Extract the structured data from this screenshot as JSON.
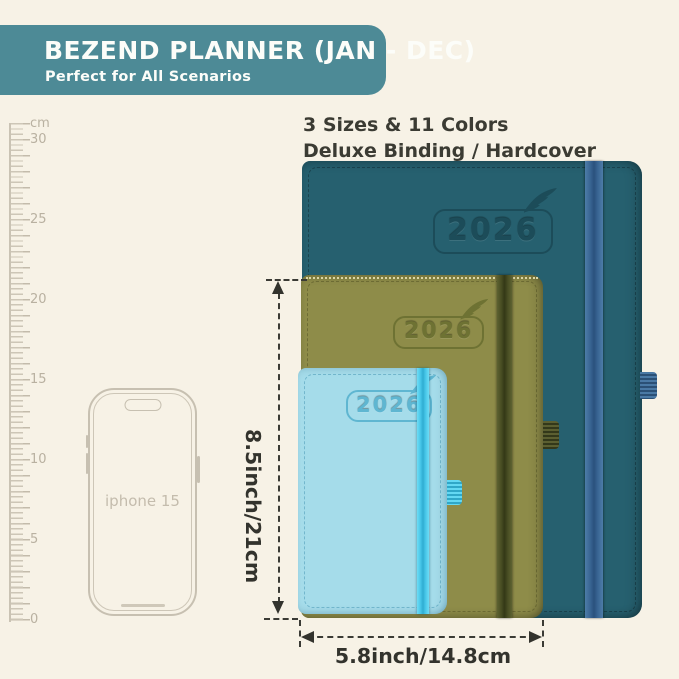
{
  "banner": {
    "title": "BEZEND PLANNER (JAN - DEC)",
    "subtitle": "Perfect for All Scenarios",
    "bg_color": "#4d8a96"
  },
  "header": {
    "line1": "3 Sizes & 11 Colors",
    "line2": "Deluxe Binding / Hardcover"
  },
  "ruler": {
    "unit": "cm",
    "labels": [
      "30",
      "25",
      "20",
      "15",
      "10",
      "5",
      "0"
    ]
  },
  "phone": {
    "label": "iphone 15"
  },
  "planners": {
    "large": {
      "year": "2026",
      "color": "#26606f",
      "elastic_color": "#3a6694"
    },
    "medium": {
      "year": "2026",
      "color": "#8e8c49",
      "elastic_color": "#474c22"
    },
    "small": {
      "year": "2026",
      "color": "#a5dcea",
      "elastic_color": "#46c6e8"
    }
  },
  "dimensions": {
    "height_label": "8.5inch/21cm",
    "width_label": "5.8inch/14.8cm"
  },
  "colors": {
    "background": "#f7f2e6",
    "annotation": "#33332d",
    "ruler": "#c3bbab"
  }
}
